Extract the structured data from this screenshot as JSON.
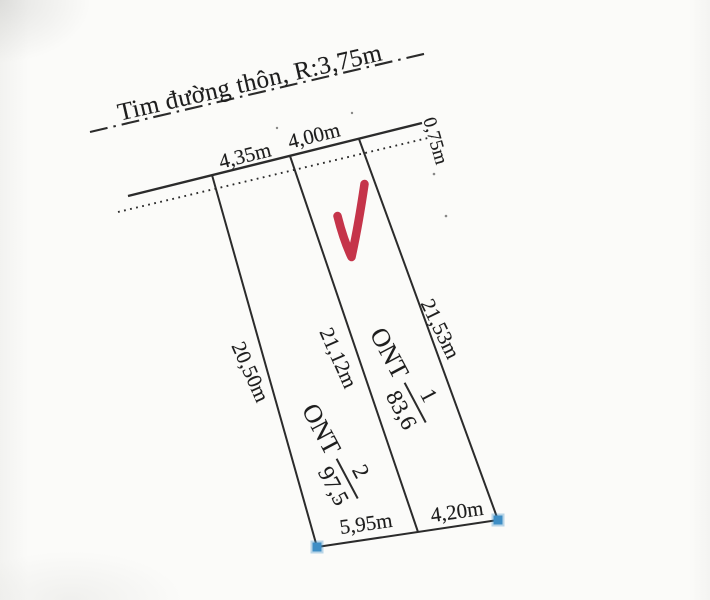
{
  "plan": {
    "road_label": "Tim đường thôn, R:3,75m",
    "dimensions": {
      "front_left": "4,35m",
      "front_right": "4,00m",
      "road_offset": "0,75m",
      "side_left": "20,50m",
      "side_middle": "21,12m",
      "side_right": "21,53m",
      "rear_left": "5,95m",
      "rear_right": "4,20m"
    },
    "parcels": [
      {
        "zone": "ONT",
        "number": "1",
        "area": "83,6"
      },
      {
        "zone": "ONT",
        "number": "2",
        "area": "97,5"
      }
    ],
    "colors": {
      "line": "#2b2b2b",
      "text": "#1d1d1d",
      "checkmark_red": "#c5344a",
      "corner_marker_blue": "#3e8ec5",
      "background": "#f3f3f0",
      "paper": "#fbfbf9"
    }
  }
}
